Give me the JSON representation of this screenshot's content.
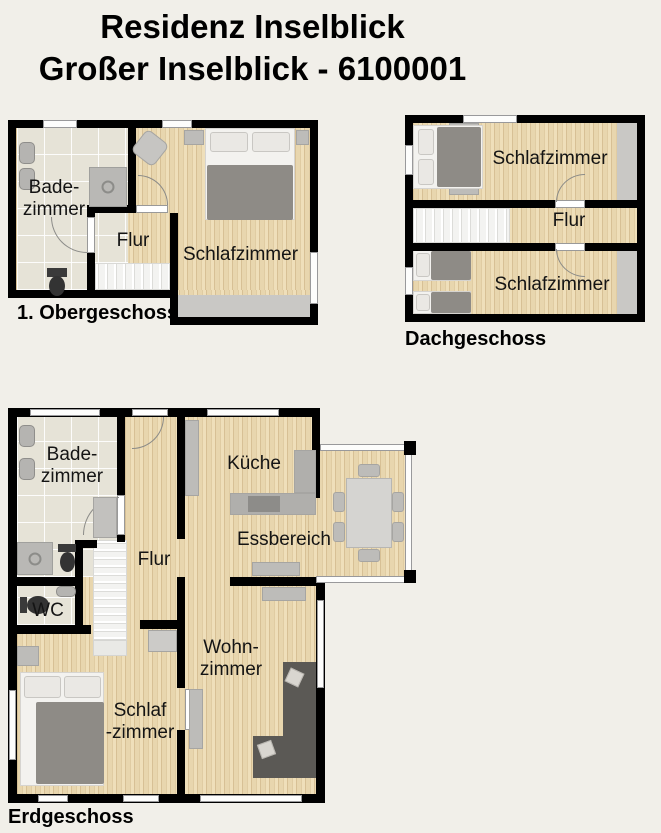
{
  "title": {
    "line1": "Residenz Inselblick",
    "line2": "Großer Inselblick -  6100001"
  },
  "floors": {
    "og": {
      "label": "1. Obergeschoss",
      "rooms": {
        "bad1": "Bade-",
        "bad2": "zimmer",
        "flur": "Flur",
        "schlafzimmer": "Schlafzimmer"
      }
    },
    "dg": {
      "label": "Dachgeschoss",
      "rooms": {
        "schlafzimmer_top": "Schlafzimmer",
        "flur": "Flur",
        "schlafzimmer_bottom": "Schlafzimmer"
      }
    },
    "eg": {
      "label": "Erdgeschoss",
      "rooms": {
        "bad1": "Bade-",
        "bad2": "zimmer",
        "kueche": "Küche",
        "essbereich": "Essbereich",
        "flur": "Flur",
        "wc": "WC",
        "wohn1": "Wohn-",
        "wohn2": "zimmer",
        "schlaf1": "Schlaf",
        "schlaf2": "-zimmer"
      }
    }
  },
  "colors": {
    "background": "#f1efe9",
    "wall": "#000000",
    "wood_floor": "#e8d6ae",
    "tile_floor": "#e6e3d7",
    "knee_strip": "#c9c8c5",
    "stairs": "#f3f3f1",
    "furniture_gray": "#bdbcb9",
    "sofa_dark": "#5b5955",
    "bed_blanket": "#8e8b86",
    "window": "#fdfdfc"
  }
}
